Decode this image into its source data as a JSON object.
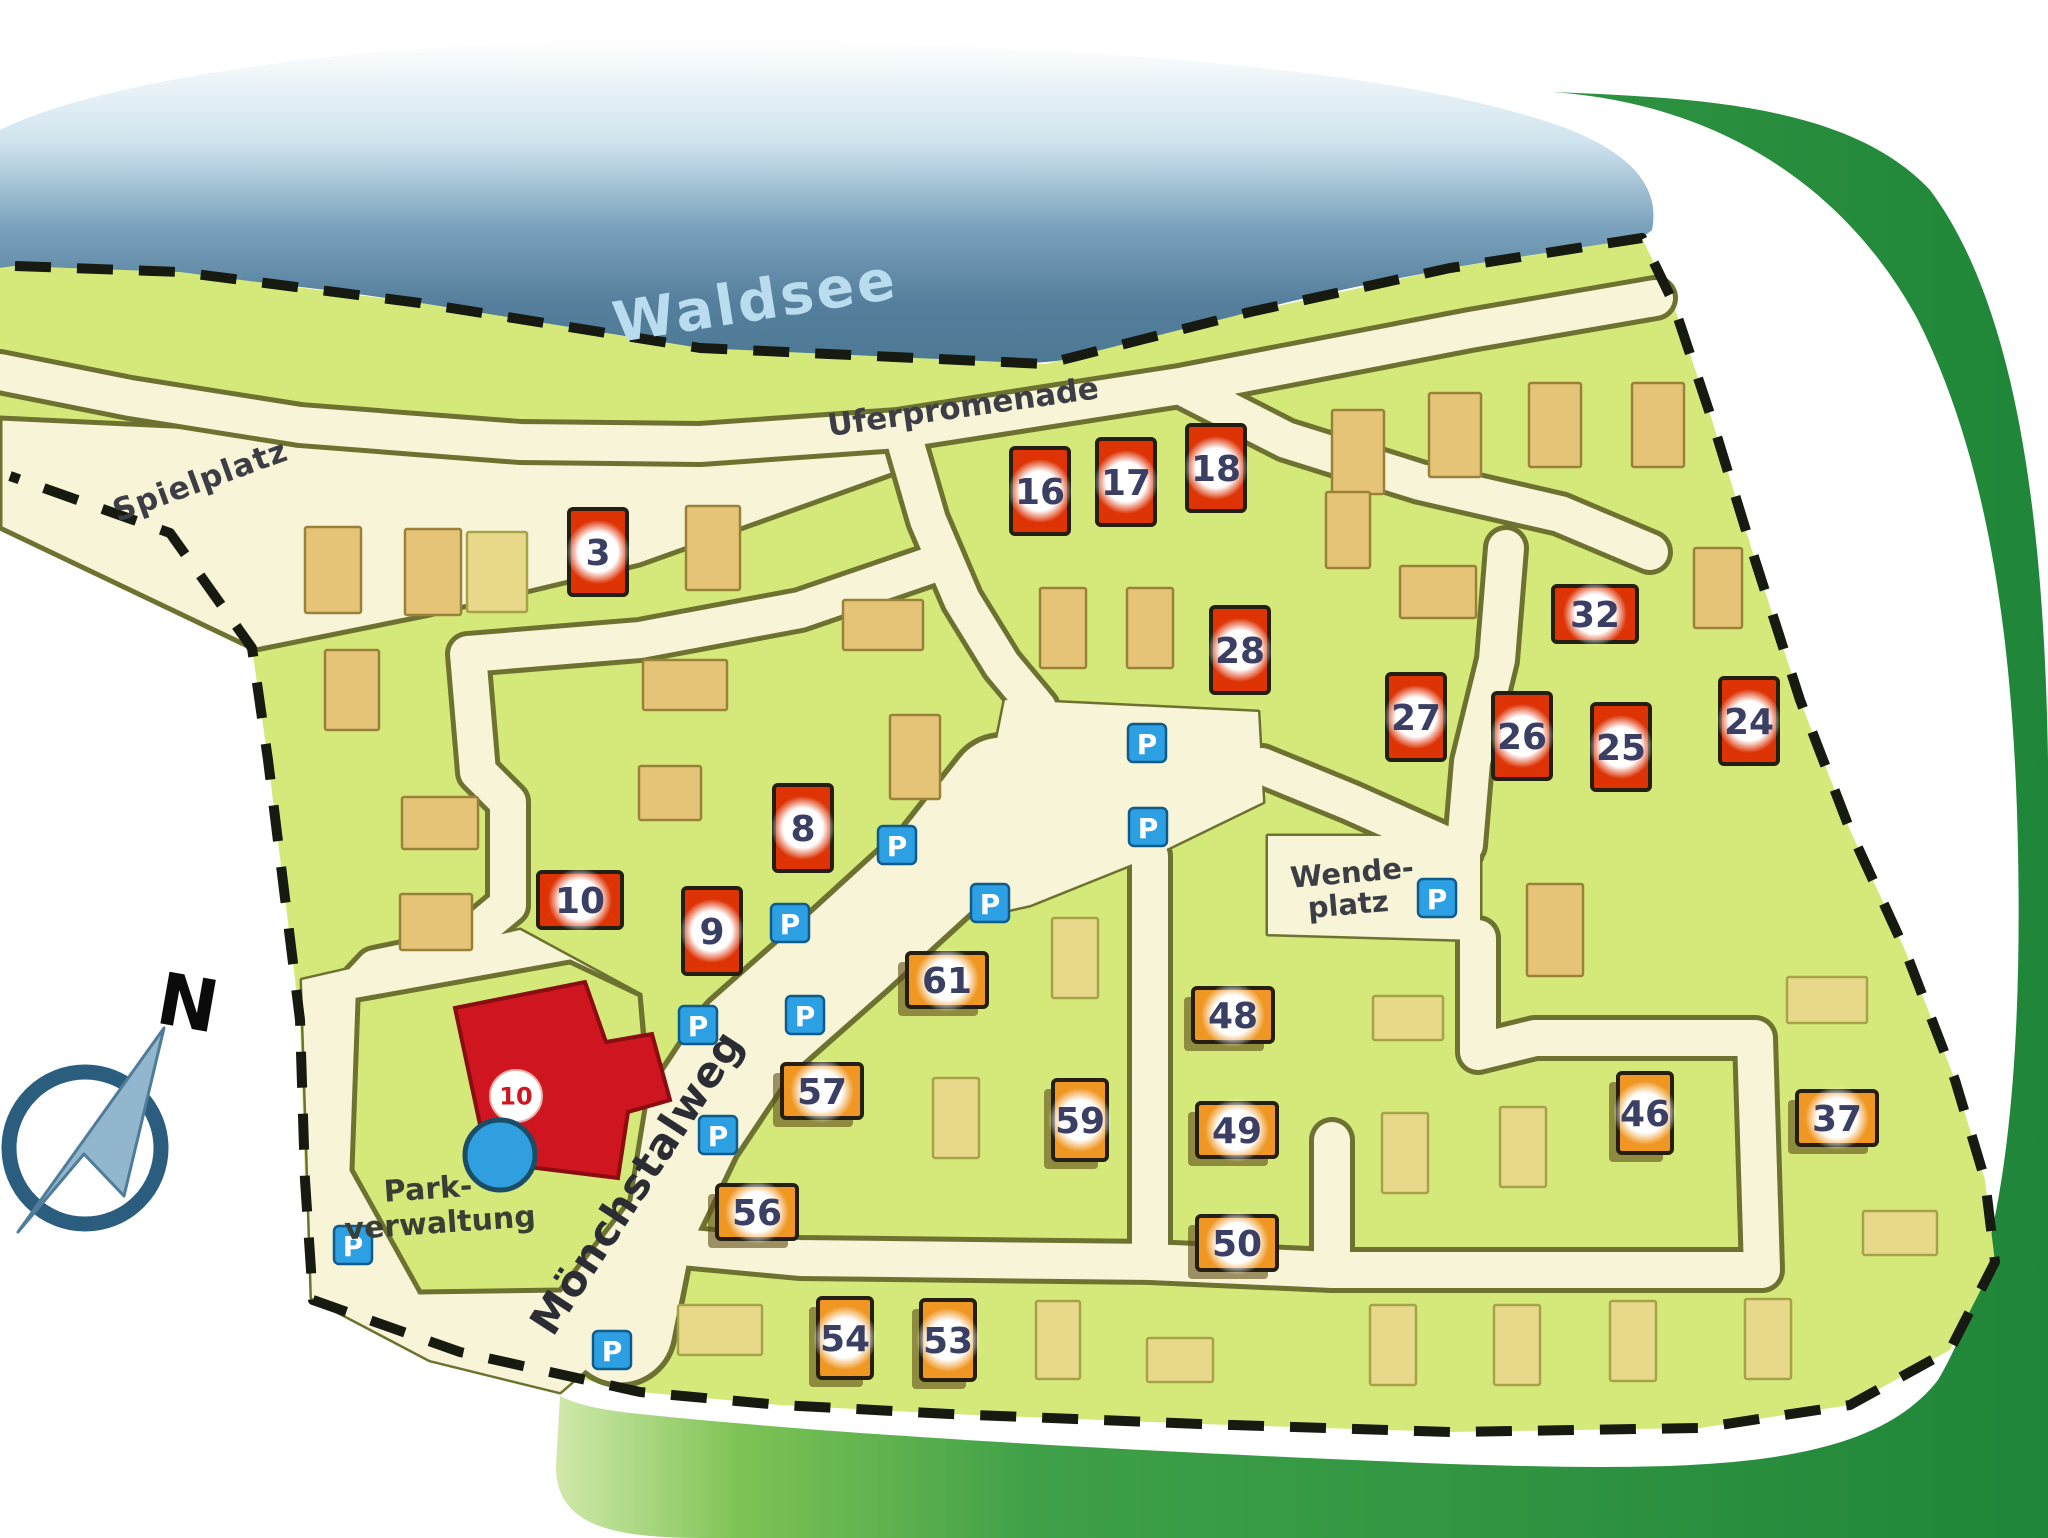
{
  "map": {
    "region_labels": [
      {
        "id": "lake-label",
        "text": "Waldsee",
        "x": 755,
        "y": 300,
        "rotate": -9,
        "size": 56,
        "color": "#b9dcee",
        "spacing": 3
      },
      {
        "id": "shore-road-label",
        "text": "Uferpromenade",
        "x": 963,
        "y": 406,
        "rotate": -8,
        "size": 31,
        "color": "#3d3d45",
        "spacing": 0
      },
      {
        "id": "playground-label",
        "text": "Spielplatz",
        "x": 200,
        "y": 480,
        "rotate": -20,
        "size": 31,
        "color": "#3d3d45",
        "spacing": 1
      },
      {
        "id": "street-label",
        "text": "Mönchstalweg",
        "x": 636,
        "y": 1182,
        "rotate": -57,
        "size": 42,
        "color": "#2c2c34",
        "spacing": 1
      },
      {
        "id": "turning-area-label-line1",
        "text": "Wende-",
        "x": 1352,
        "y": 872,
        "rotate": -5,
        "size": 29,
        "color": "#3d3d45",
        "spacing": 0
      },
      {
        "id": "turning-area-label-line2",
        "text": "platz",
        "x": 1348,
        "y": 904,
        "rotate": -5,
        "size": 29,
        "color": "#3d3d45",
        "spacing": 0
      },
      {
        "id": "admin-label-line1",
        "text": "Park-",
        "x": 428,
        "y": 1188,
        "rotate": -4,
        "size": 30,
        "color": "#3a3f35",
        "spacing": 0
      },
      {
        "id": "admin-label-line2",
        "text": "verwaltung",
        "x": 440,
        "y": 1222,
        "rotate": -4,
        "size": 30,
        "color": "#3a3f35",
        "spacing": 0
      }
    ],
    "compass": {
      "label": "N"
    },
    "admin_badge": {
      "text": "10"
    },
    "parking_label": "P",
    "parking_positions": [
      [
        1147,
        743
      ],
      [
        1148,
        827
      ],
      [
        897,
        845
      ],
      [
        990,
        903
      ],
      [
        790,
        923
      ],
      [
        698,
        1025
      ],
      [
        805,
        1015
      ],
      [
        718,
        1135
      ],
      [
        1437,
        898
      ],
      [
        353,
        1245
      ],
      [
        612,
        1350
      ]
    ],
    "site_markers": [
      {
        "number": "3",
        "x": 598,
        "y": 552,
        "type": "red",
        "orient": "portrait"
      },
      {
        "number": "16",
        "x": 1040,
        "y": 491,
        "type": "red",
        "orient": "portrait"
      },
      {
        "number": "17",
        "x": 1126,
        "y": 482,
        "type": "red",
        "orient": "portrait"
      },
      {
        "number": "18",
        "x": 1216,
        "y": 468,
        "type": "red",
        "orient": "portrait"
      },
      {
        "number": "28",
        "x": 1240,
        "y": 650,
        "type": "red",
        "orient": "portrait"
      },
      {
        "number": "27",
        "x": 1416,
        "y": 717,
        "type": "red",
        "orient": "portrait"
      },
      {
        "number": "26",
        "x": 1522,
        "y": 736,
        "type": "red",
        "orient": "portrait"
      },
      {
        "number": "25",
        "x": 1621,
        "y": 747,
        "type": "red",
        "orient": "portrait"
      },
      {
        "number": "24",
        "x": 1749,
        "y": 721,
        "type": "red",
        "orient": "portrait"
      },
      {
        "number": "32",
        "x": 1595,
        "y": 614,
        "type": "red",
        "orient": "landscape"
      },
      {
        "number": "8",
        "x": 803,
        "y": 828,
        "type": "red",
        "orient": "portrait"
      },
      {
        "number": "9",
        "x": 712,
        "y": 931,
        "type": "red",
        "orient": "portrait"
      },
      {
        "number": "10",
        "x": 580,
        "y": 900,
        "type": "red",
        "orient": "landscape"
      },
      {
        "number": "61",
        "x": 947,
        "y": 980,
        "type": "orange",
        "orient": "landscape"
      },
      {
        "number": "57",
        "x": 822,
        "y": 1091,
        "type": "orange",
        "orient": "landscape"
      },
      {
        "number": "56",
        "x": 757,
        "y": 1212,
        "type": "orange",
        "orient": "landscape"
      },
      {
        "number": "59",
        "x": 1080,
        "y": 1120,
        "type": "orange",
        "orient": "portrait"
      },
      {
        "number": "54",
        "x": 845,
        "y": 1338,
        "type": "orange",
        "orient": "portrait"
      },
      {
        "number": "53",
        "x": 948,
        "y": 1340,
        "type": "orange",
        "orient": "portrait"
      },
      {
        "number": "48",
        "x": 1233,
        "y": 1015,
        "type": "orange",
        "orient": "landscape"
      },
      {
        "number": "49",
        "x": 1237,
        "y": 1130,
        "type": "orange",
        "orient": "landscape"
      },
      {
        "number": "50",
        "x": 1237,
        "y": 1243,
        "type": "orange",
        "orient": "landscape"
      },
      {
        "number": "46",
        "x": 1645,
        "y": 1113,
        "type": "orange",
        "orient": "portrait"
      },
      {
        "number": "37",
        "x": 1837,
        "y": 1118,
        "type": "orange",
        "orient": "landscape"
      }
    ],
    "buildings": [
      {
        "x": 333,
        "y": 570,
        "w": 56,
        "h": 86,
        "tone": "tan"
      },
      {
        "x": 433,
        "y": 572,
        "w": 56,
        "h": 86,
        "tone": "tan"
      },
      {
        "x": 497,
        "y": 572,
        "w": 60,
        "h": 80,
        "tone": "pale"
      },
      {
        "x": 713,
        "y": 548,
        "w": 54,
        "h": 84,
        "tone": "tan"
      },
      {
        "x": 352,
        "y": 690,
        "w": 54,
        "h": 80,
        "tone": "tan"
      },
      {
        "x": 685,
        "y": 685,
        "w": 84,
        "h": 50,
        "tone": "tan"
      },
      {
        "x": 670,
        "y": 793,
        "w": 62,
        "h": 54,
        "tone": "tan"
      },
      {
        "x": 883,
        "y": 625,
        "w": 80,
        "h": 50,
        "tone": "tan"
      },
      {
        "x": 915,
        "y": 757,
        "w": 50,
        "h": 84,
        "tone": "tan"
      },
      {
        "x": 440,
        "y": 823,
        "w": 76,
        "h": 52,
        "tone": "tan"
      },
      {
        "x": 436,
        "y": 922,
        "w": 72,
        "h": 56,
        "tone": "tan"
      },
      {
        "x": 1063,
        "y": 628,
        "w": 46,
        "h": 80,
        "tone": "tan"
      },
      {
        "x": 1150,
        "y": 628,
        "w": 46,
        "h": 80,
        "tone": "tan"
      },
      {
        "x": 1358,
        "y": 452,
        "w": 52,
        "h": 84,
        "tone": "tan"
      },
      {
        "x": 1455,
        "y": 435,
        "w": 52,
        "h": 84,
        "tone": "tan"
      },
      {
        "x": 1555,
        "y": 425,
        "w": 52,
        "h": 84,
        "tone": "tan"
      },
      {
        "x": 1658,
        "y": 425,
        "w": 52,
        "h": 84,
        "tone": "tan"
      },
      {
        "x": 1438,
        "y": 592,
        "w": 76,
        "h": 52,
        "tone": "tan"
      },
      {
        "x": 1718,
        "y": 588,
        "w": 48,
        "h": 80,
        "tone": "tan"
      },
      {
        "x": 1348,
        "y": 530,
        "w": 44,
        "h": 76,
        "tone": "tan"
      },
      {
        "x": 1555,
        "y": 930,
        "w": 56,
        "h": 92,
        "tone": "tan"
      },
      {
        "x": 1075,
        "y": 958,
        "w": 46,
        "h": 80,
        "tone": "pale"
      },
      {
        "x": 956,
        "y": 1118,
        "w": 46,
        "h": 80,
        "tone": "pale"
      },
      {
        "x": 1058,
        "y": 1340,
        "w": 44,
        "h": 78,
        "tone": "pale"
      },
      {
        "x": 1180,
        "y": 1360,
        "w": 66,
        "h": 44,
        "tone": "pale"
      },
      {
        "x": 720,
        "y": 1330,
        "w": 84,
        "h": 50,
        "tone": "pale"
      },
      {
        "x": 1408,
        "y": 1018,
        "w": 70,
        "h": 44,
        "tone": "pale"
      },
      {
        "x": 1405,
        "y": 1153,
        "w": 46,
        "h": 80,
        "tone": "pale"
      },
      {
        "x": 1523,
        "y": 1147,
        "w": 46,
        "h": 80,
        "tone": "pale"
      },
      {
        "x": 1393,
        "y": 1345,
        "w": 46,
        "h": 80,
        "tone": "pale"
      },
      {
        "x": 1517,
        "y": 1345,
        "w": 46,
        "h": 80,
        "tone": "pale"
      },
      {
        "x": 1633,
        "y": 1341,
        "w": 46,
        "h": 80,
        "tone": "pale"
      },
      {
        "x": 1768,
        "y": 1339,
        "w": 46,
        "h": 80,
        "tone": "pale"
      },
      {
        "x": 1827,
        "y": 1000,
        "w": 80,
        "h": 46,
        "tone": "pale"
      },
      {
        "x": 1900,
        "y": 1233,
        "w": 74,
        "h": 44,
        "tone": "pale"
      }
    ],
    "colors": {
      "lake": "#4e7a96",
      "park": "#d5e97b",
      "road_fill": "#f8f4d8",
      "road_edge": "#6e7230",
      "forest": "#2f9440",
      "marker_red": "#dd3305",
      "marker_orange": "#ef9722",
      "parking_blue": "#2da0e4",
      "admin_building_red": "#cf1520",
      "number_ink": "#3a3f63"
    }
  }
}
